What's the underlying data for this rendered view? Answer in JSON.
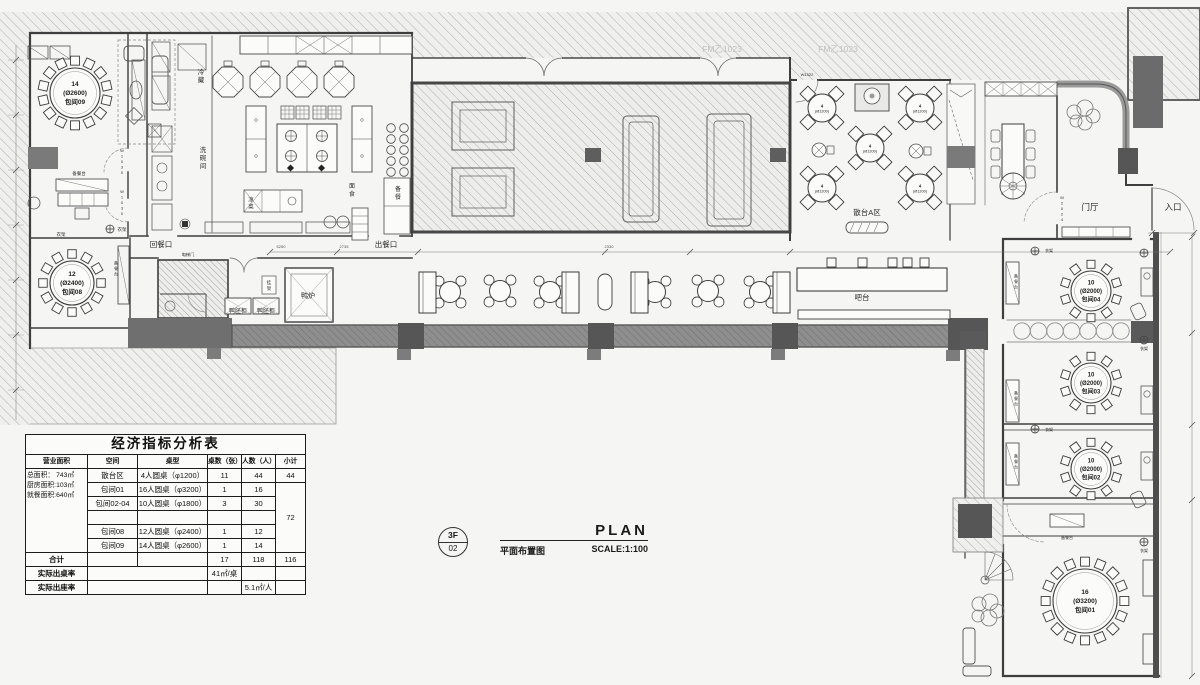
{
  "meta": {
    "paper": "#f5f5f4",
    "ink": "#3e3e3e",
    "hatch_line": "#b5b5b3",
    "dark_fill": "#5a5a5a",
    "band_fill": "#8e8e8e",
    "gray_tag": "#c0c0bf"
  },
  "title_block": {
    "floor": "3F",
    "sheet": "02",
    "name_en": "PLAN",
    "name_cn": "平面布置图",
    "scale": "SCALE:1:100"
  },
  "analysis_table": {
    "title": "经济指标分析表",
    "headers": [
      "营业面积",
      "空间",
      "桌型",
      "桌数（张）",
      "人数（人）",
      "小计"
    ],
    "area_summary": [
      "总面积： 743㎡",
      "厨房面积:103㎡",
      "就餐面积:640㎡"
    ],
    "rows": [
      {
        "space": "散台区",
        "type": "4人圆桌（φ1200）",
        "count": "11",
        "people": "44",
        "subtotal": "44"
      },
      {
        "space": "包间01",
        "type": "16人圆桌（φ3200）",
        "count": "1",
        "people": "16"
      },
      {
        "space": "包间02-04",
        "type": "10人圆桌（φ1800）",
        "count": "3",
        "people": "30"
      },
      {
        "space": "",
        "type": "",
        "count": "",
        "people": ""
      },
      {
        "space": "包间08",
        "type": "12人圆桌（φ2400）",
        "count": "1",
        "people": "12"
      },
      {
        "space": "包间09",
        "type": "14人圆桌（φ2600）",
        "count": "1",
        "people": "14"
      }
    ],
    "merged_subtotal": "72",
    "total": {
      "label": "合计",
      "count": "17",
      "people": "118",
      "subtotal": "116"
    },
    "table_rate": {
      "label": "实际出桌率",
      "value": "41㎡/桌"
    },
    "seat_rate": {
      "label": "实际出座率",
      "value": "5.1㎡/人"
    }
  },
  "plan": {
    "labels": [
      {
        "n": "cold-storage",
        "t": "冷藏",
        "x": 201,
        "y": 78,
        "s": 6.5,
        "v": 1
      },
      {
        "n": "dishwash-room",
        "t": "洗碗间",
        "x": 203,
        "y": 160,
        "s": 6.5,
        "v": 1
      },
      {
        "n": "cold-dish",
        "t": "凉菜",
        "x": 251,
        "y": 205,
        "s": 5.5,
        "v": 1
      },
      {
        "n": "noodle-station",
        "t": "面食",
        "x": 352,
        "y": 192,
        "s": 6,
        "v": 1
      },
      {
        "n": "prep-station",
        "t": "备餐",
        "x": 398,
        "y": 195,
        "s": 6,
        "v": 1
      },
      {
        "n": "return-opening",
        "t": "回餐口",
        "x": 161,
        "y": 247,
        "s": 7.5
      },
      {
        "n": "serve-opening",
        "t": "出餐口",
        "x": 386,
        "y": 247,
        "s": 7.5
      },
      {
        "n": "duck-oven",
        "t": "鸭炉",
        "x": 308,
        "y": 298,
        "s": 7
      },
      {
        "n": "duck-cabinet-1",
        "t": "鸭胚柜",
        "x": 238,
        "y": 313,
        "s": 6
      },
      {
        "n": "duck-cabinet-2",
        "t": "鸭胚柜",
        "x": 266,
        "y": 313,
        "s": 6
      },
      {
        "n": "hanging-rack",
        "t": "挂架",
        "x": 269,
        "y": 287,
        "s": 4.5,
        "v": 1
      },
      {
        "n": "elevator-door",
        "t": "电梯门",
        "x": 188,
        "y": 256,
        "s": 4.2
      },
      {
        "n": "scatter-area-a",
        "t": "散台A区",
        "x": 867,
        "y": 215,
        "s": 7.5
      },
      {
        "n": "bar-counter",
        "t": "吧台",
        "x": 862,
        "y": 300,
        "s": 7.5
      },
      {
        "n": "foyer",
        "t": "门厅",
        "x": 1090,
        "y": 210,
        "s": 8.5
      },
      {
        "n": "entrance",
        "t": "入口",
        "x": 1173,
        "y": 210,
        "s": 8.5
      },
      {
        "n": "door-tag-m2024",
        "t": "M2024",
        "x": 1062,
        "y": 210,
        "s": 4,
        "v": 1
      },
      {
        "n": "door-tag-w1522",
        "t": "W1522",
        "x": 807,
        "y": 76,
        "s": 4
      },
      {
        "n": "door-tag-w1030-1",
        "t": "W1030",
        "x": 122,
        "y": 163,
        "s": 4,
        "v": 1
      },
      {
        "n": "door-tag-w1030-2",
        "t": "W1030",
        "x": 122,
        "y": 204,
        "s": 4,
        "v": 1
      },
      {
        "n": "coat-rack-09",
        "t": "衣架",
        "x": 122,
        "y": 231,
        "s": 4.5
      },
      {
        "n": "coat-rack-08",
        "t": "衣架",
        "x": 61,
        "y": 236,
        "s": 4.5
      },
      {
        "n": "prep-counter-09",
        "t": "备餐台",
        "x": 79,
        "y": 175,
        "s": 4.5
      },
      {
        "n": "prep-counter-08",
        "t": "备餐台",
        "x": 116,
        "y": 270,
        "s": 4,
        "v": 1
      },
      {
        "n": "fire-door-tag-1",
        "t": "FM乙1023",
        "x": 722,
        "y": 52,
        "s": 8.5,
        "c": "#c0c0bf"
      },
      {
        "n": "fire-door-tag-2",
        "t": "FM乙1023",
        "x": 838,
        "y": 52,
        "s": 8.5,
        "c": "#c0c0bf"
      },
      {
        "n": "dim-5250",
        "t": "5250",
        "x": 281,
        "y": 248,
        "s": 4,
        "c": "#555555"
      },
      {
        "n": "dim-2735",
        "t": "2735",
        "x": 344,
        "y": 248,
        "s": 4,
        "c": "#555555"
      },
      {
        "n": "dim-2330",
        "t": "2330",
        "x": 609,
        "y": 248,
        "s": 4,
        "c": "#555555"
      },
      {
        "n": "prep-counter-04",
        "t": "备餐台",
        "x": 1016,
        "y": 283,
        "s": 4,
        "v": 1
      },
      {
        "n": "prep-counter-03",
        "t": "备餐台",
        "x": 1016,
        "y": 400,
        "s": 4,
        "v": 1
      },
      {
        "n": "prep-counter-02",
        "t": "备餐台",
        "x": 1016,
        "y": 463,
        "s": 4,
        "v": 1
      },
      {
        "n": "prep-counter-01",
        "t": "备餐台",
        "x": 1067,
        "y": 539,
        "s": 4
      },
      {
        "n": "coat-rack-04",
        "t": "衣架",
        "x": 1049,
        "y": 252,
        "s": 4
      },
      {
        "n": "coat-rack-02",
        "t": "衣架",
        "x": 1049,
        "y": 431,
        "s": 4
      },
      {
        "n": "coat-rack-corridor",
        "t": "衣架",
        "x": 1144,
        "y": 350,
        "s": 4
      },
      {
        "n": "coat-rack-01",
        "t": "衣架",
        "x": 1144,
        "y": 552,
        "s": 4
      }
    ],
    "round_tables": [
      {
        "n": "round-table-baojian09",
        "cx": 75,
        "cy": 93,
        "r": 25,
        "seats": 14,
        "chair": 9,
        "ls": 6.5,
        "lines": [
          "14",
          "(Ø2600)",
          "包间09"
        ]
      },
      {
        "n": "round-table-baojian08",
        "cx": 72,
        "cy": 283,
        "r": 22,
        "seats": 12,
        "chair": 8.5,
        "ls": 6.5,
        "lines": [
          "12",
          "(Ø2400)",
          "包间08"
        ]
      },
      {
        "n": "round-table-baojian04",
        "cx": 1091,
        "cy": 291,
        "r": 20,
        "seats": 10,
        "chair": 8,
        "ls": 6,
        "lines": [
          "10",
          "(Ø2000)",
          "包间04"
        ]
      },
      {
        "n": "round-table-baojian03",
        "cx": 1091,
        "cy": 383,
        "r": 20,
        "seats": 10,
        "chair": 8,
        "ls": 6,
        "lines": [
          "10",
          "(Ø2000)",
          "包间03"
        ]
      },
      {
        "n": "round-table-baojian02",
        "cx": 1091,
        "cy": 469,
        "r": 20,
        "seats": 10,
        "chair": 8,
        "ls": 6,
        "lines": [
          "10",
          "(Ø2000)",
          "包间02"
        ]
      },
      {
        "n": "round-table-baojian01",
        "cx": 1085,
        "cy": 601,
        "r": 32,
        "seats": 16,
        "chair": 9,
        "ls": 6.5,
        "lines": [
          "16",
          "(Ø3200)",
          "包间01"
        ]
      }
    ],
    "scatter_table_label": {
      "seats": "4",
      "size": "(Ø1200)"
    },
    "diamond_tables": [
      {
        "cx": 822,
        "cy": 108
      },
      {
        "cx": 920,
        "cy": 108
      },
      {
        "cx": 870,
        "cy": 148
      },
      {
        "cx": 822,
        "cy": 188
      },
      {
        "cx": 920,
        "cy": 188
      }
    ],
    "small_tables": [
      {
        "cx": 450,
        "cy": 292
      },
      {
        "cx": 500,
        "cy": 291
      },
      {
        "cx": 550,
        "cy": 292
      },
      {
        "cx": 655,
        "cy": 292
      },
      {
        "cx": 708,
        "cy": 291
      },
      {
        "cx": 760,
        "cy": 292
      }
    ],
    "capsule_table": {
      "cx": 605,
      "cy": 292
    },
    "booths": [
      {
        "x": 419,
        "y": 272,
        "w": 17,
        "h": 41
      },
      {
        "x": 562,
        "y": 272,
        "w": 17,
        "h": 41
      },
      {
        "x": 631,
        "y": 272,
        "w": 17,
        "h": 41
      },
      {
        "x": 773,
        "y": 272,
        "w": 17,
        "h": 41
      }
    ],
    "bar_stools": {
      "y": 258,
      "xs": [
        827,
        858,
        888,
        903,
        920
      ]
    },
    "corridor_circles": {
      "y": 331,
      "xs": [
        1022,
        1038.5,
        1055,
        1071.5,
        1088,
        1104.5,
        1121
      ]
    },
    "coat_hooks": [
      {
        "x": 110,
        "y": 229
      },
      {
        "x": 1035,
        "y": 251
      },
      {
        "x": 1035,
        "y": 429
      },
      {
        "x": 1144,
        "y": 340
      },
      {
        "x": 1144,
        "y": 542
      },
      {
        "x": 1144,
        "y": 253
      }
    ],
    "wok_stations": {
      "y": 82,
      "xs": [
        228,
        265,
        302,
        339
      ]
    },
    "steamer_circles": {
      "xs": [
        391,
        404
      ],
      "ys": [
        128,
        139,
        150,
        161,
        172
      ]
    }
  }
}
